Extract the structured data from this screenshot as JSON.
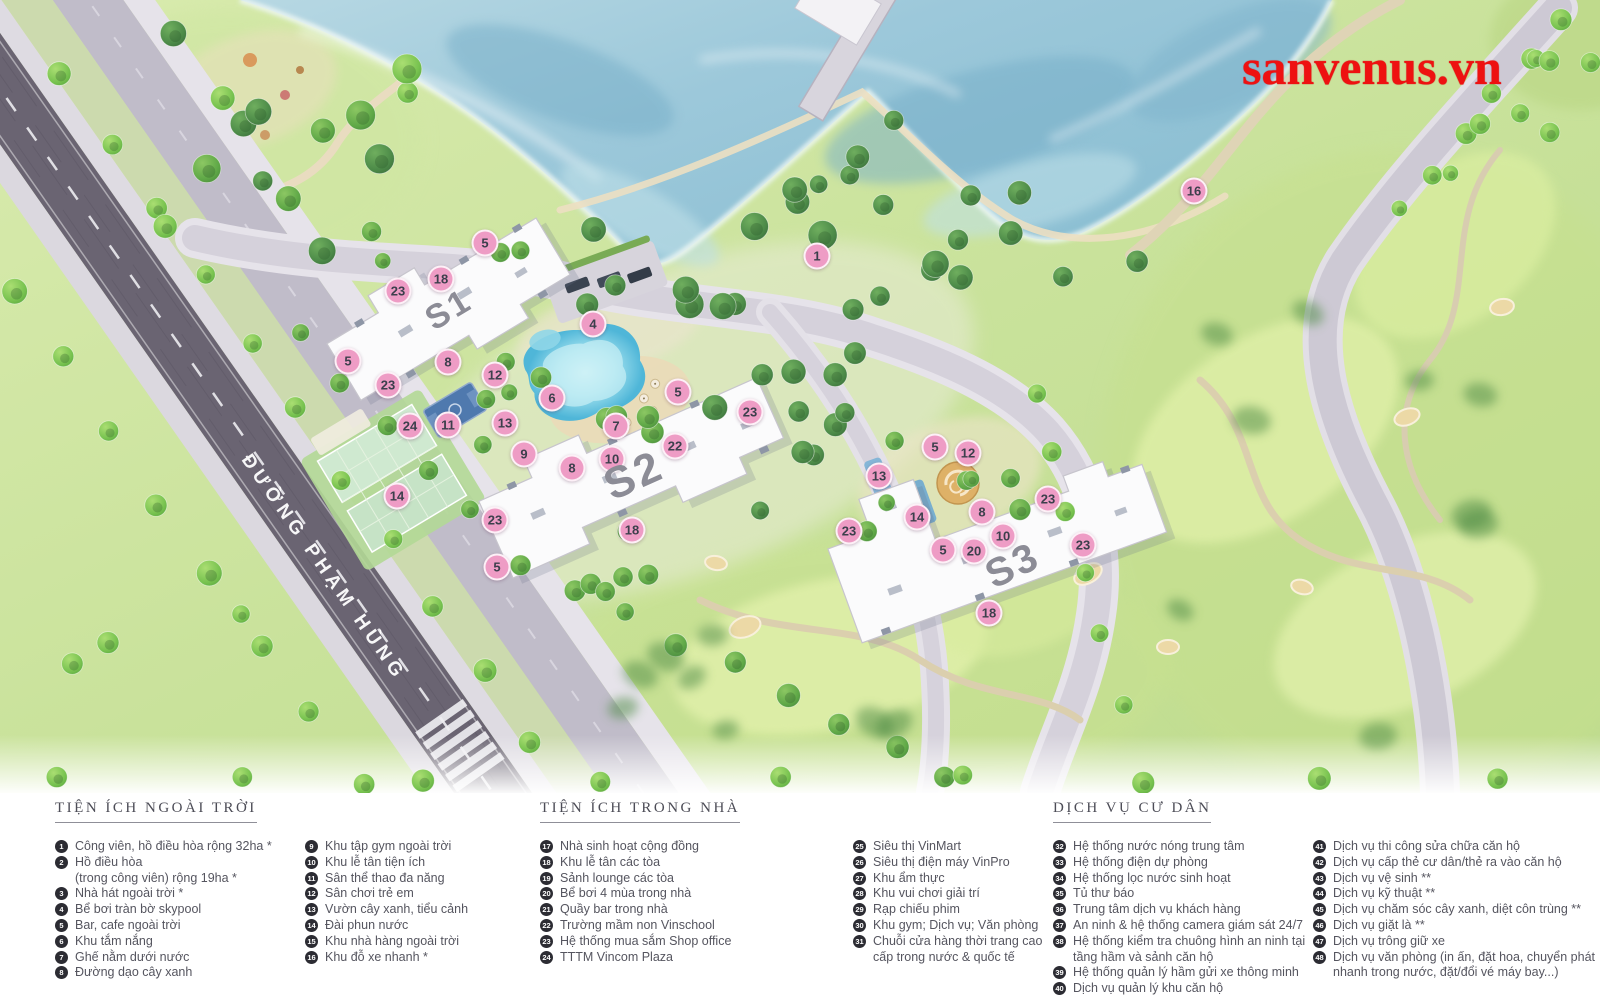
{
  "map": {
    "watermark": "sanvenus.vn",
    "road_label": "ĐƯỜNG PHẠM HÙNG",
    "buildings": [
      {
        "label": "S1",
        "x": 449,
        "y": 310,
        "angle": -31,
        "size": 34
      },
      {
        "label": "S2",
        "x": 634,
        "y": 476,
        "angle": -24,
        "size": 44
      },
      {
        "label": "S3",
        "x": 1013,
        "y": 566,
        "angle": -26,
        "size": 40
      }
    ],
    "markers": [
      {
        "n": "1",
        "x": 817,
        "y": 256
      },
      {
        "n": "16",
        "x": 1194,
        "y": 191
      },
      {
        "n": "5",
        "x": 485,
        "y": 243
      },
      {
        "n": "18",
        "x": 441,
        "y": 279
      },
      {
        "n": "23",
        "x": 398,
        "y": 291
      },
      {
        "n": "4",
        "x": 593,
        "y": 324
      },
      {
        "n": "5",
        "x": 348,
        "y": 361
      },
      {
        "n": "8",
        "x": 448,
        "y": 362
      },
      {
        "n": "12",
        "x": 495,
        "y": 375
      },
      {
        "n": "23",
        "x": 388,
        "y": 385
      },
      {
        "n": "6",
        "x": 552,
        "y": 398
      },
      {
        "n": "5",
        "x": 678,
        "y": 392
      },
      {
        "n": "11",
        "x": 448,
        "y": 425
      },
      {
        "n": "13",
        "x": 505,
        "y": 423
      },
      {
        "n": "24",
        "x": 410,
        "y": 426
      },
      {
        "n": "7",
        "x": 616,
        "y": 426
      },
      {
        "n": "23",
        "x": 750,
        "y": 412
      },
      {
        "n": "22",
        "x": 675,
        "y": 446
      },
      {
        "n": "9",
        "x": 524,
        "y": 454
      },
      {
        "n": "10",
        "x": 612,
        "y": 459
      },
      {
        "n": "8",
        "x": 572,
        "y": 468
      },
      {
        "n": "14",
        "x": 397,
        "y": 496
      },
      {
        "n": "23",
        "x": 495,
        "y": 520
      },
      {
        "n": "18",
        "x": 632,
        "y": 530
      },
      {
        "n": "5",
        "x": 497,
        "y": 567
      },
      {
        "n": "5",
        "x": 935,
        "y": 447
      },
      {
        "n": "12",
        "x": 968,
        "y": 453
      },
      {
        "n": "13",
        "x": 879,
        "y": 476
      },
      {
        "n": "23",
        "x": 1048,
        "y": 499
      },
      {
        "n": "8",
        "x": 982,
        "y": 512
      },
      {
        "n": "14",
        "x": 917,
        "y": 517
      },
      {
        "n": "23",
        "x": 849,
        "y": 531
      },
      {
        "n": "10",
        "x": 1003,
        "y": 536
      },
      {
        "n": "23",
        "x": 1083,
        "y": 545
      },
      {
        "n": "5",
        "x": 943,
        "y": 550
      },
      {
        "n": "20",
        "x": 974,
        "y": 551
      },
      {
        "n": "18",
        "x": 989,
        "y": 613
      }
    ]
  },
  "legend": {
    "sections": [
      {
        "title": "TIỆN ÍCH NGOÀI TRỜI",
        "columns": [
          [
            {
              "n": "1",
              "t": "Công viên, hồ điều hòa rộng 32ha *"
            },
            {
              "n": "2",
              "t": "Hồ điều hòa",
              "t2": "(trong công viên) rộng 19ha *"
            },
            {
              "n": "3",
              "t": "Nhà hát ngoài trời *"
            },
            {
              "n": "4",
              "t": "Bể bơi tràn bờ skypool"
            },
            {
              "n": "5",
              "t": "Bar, cafe ngoài trời"
            },
            {
              "n": "6",
              "t": "Khu tắm nắng"
            },
            {
              "n": "7",
              "t": "Ghế nằm dưới nước"
            },
            {
              "n": "8",
              "t": "Đường dạo cây xanh"
            }
          ],
          [
            {
              "n": "9",
              "t": "Khu tập gym ngoài trời"
            },
            {
              "n": "10",
              "t": "Khu lễ tân tiện ích"
            },
            {
              "n": "11",
              "t": "Sân thể thao đa năng"
            },
            {
              "n": "12",
              "t": "Sân chơi trẻ em"
            },
            {
              "n": "13",
              "t": "Vườn cây xanh, tiểu cảnh"
            },
            {
              "n": "14",
              "t": "Đài phun nước"
            },
            {
              "n": "15",
              "t": "Khu nhà hàng ngoài trời"
            },
            {
              "n": "16",
              "t": "Khu đỗ xe nhanh *"
            }
          ]
        ]
      },
      {
        "title": "TIỆN ÍCH TRONG NHÀ",
        "columns": [
          [
            {
              "n": "17",
              "t": "Nhà sinh hoạt cộng đồng"
            },
            {
              "n": "18",
              "t": "Khu lễ tân các tòa"
            },
            {
              "n": "19",
              "t": "Sảnh lounge các tòa"
            },
            {
              "n": "20",
              "t": "Bể bơi 4 mùa trong nhà"
            },
            {
              "n": "21",
              "t": "Quầy bar trong nhà"
            },
            {
              "n": "22",
              "t": "Trường mầm non Vinschool"
            },
            {
              "n": "23",
              "t": "Hệ thống mua sắm Shop office"
            },
            {
              "n": "24",
              "t": "TTTM Vincom Plaza"
            }
          ],
          [
            {
              "n": "25",
              "t": "Siêu thị VinMart"
            },
            {
              "n": "26",
              "t": "Siêu thị điện máy VinPro"
            },
            {
              "n": "27",
              "t": "Khu ẩm thực"
            },
            {
              "n": "28",
              "t": "Khu vui chơi giải trí"
            },
            {
              "n": "29",
              "t": "Rạp chiếu phim"
            },
            {
              "n": "30",
              "t": "Khu gym; Dịch vụ; Văn phòng"
            },
            {
              "n": "31",
              "t": "Chuỗi cửa hàng thời trang cao",
              "t2": "cấp trong nước & quốc tế"
            }
          ]
        ]
      },
      {
        "title": "DỊCH VỤ CƯ DÂN",
        "columns": [
          [
            {
              "n": "32",
              "t": "Hệ thống nước nóng trung tâm"
            },
            {
              "n": "33",
              "t": "Hệ thống điện dự phòng"
            },
            {
              "n": "34",
              "t": "Hệ thống lọc nước sinh hoạt"
            },
            {
              "n": "35",
              "t": "Tủ thư báo"
            },
            {
              "n": "36",
              "t": "Trung tâm dịch vụ khách hàng"
            },
            {
              "n": "37",
              "t": "An ninh & hệ thống camera giám sát 24/7"
            },
            {
              "n": "38",
              "t": "Hệ thống kiểm tra chuông hình an ninh tại",
              "t2": "tầng hầm và sảnh căn hộ"
            },
            {
              "n": "39",
              "t": "Hệ thống quản lý hầm gửi xe thông minh"
            },
            {
              "n": "40",
              "t": "Dịch vụ quản lý khu căn hộ"
            }
          ],
          [
            {
              "n": "41",
              "t": "Dịch vụ thi công sửa chữa căn hộ"
            },
            {
              "n": "42",
              "t": "Dịch vụ cấp thẻ cư dân/thẻ ra vào căn hộ"
            },
            {
              "n": "43",
              "t": "Dịch vụ vệ sinh **"
            },
            {
              "n": "44",
              "t": "Dịch vụ kỹ thuật **"
            },
            {
              "n": "45",
              "t": "Dịch vụ chăm sóc cây xanh, diệt côn trùng **"
            },
            {
              "n": "46",
              "t": "Dịch vụ giặt là **"
            },
            {
              "n": "47",
              "t": "Dịch vụ trông giữ xe"
            },
            {
              "n": "48",
              "t": "Dịch vụ văn phòng (in ấn, đặt hoa, chuyển phát",
              "t2": "nhanh trong nước, đặt/đổi vé máy bay...)"
            }
          ]
        ]
      }
    ]
  }
}
